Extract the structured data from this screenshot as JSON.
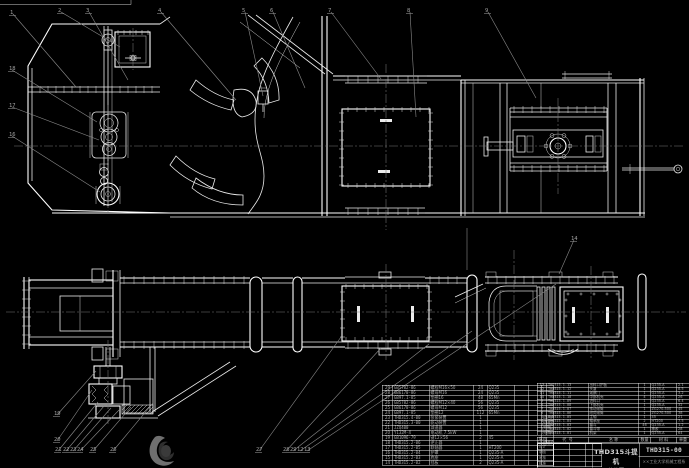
{
  "colors": {
    "background": "#000000",
    "line": "#ececec",
    "leader": "#8a8a8a",
    "table_text": "#a8a8a8",
    "stamp_dark": "#2e2e2e",
    "stamp_light": "#6f6f6f"
  },
  "title_block": {
    "product_title": "THD315斗提机",
    "sheet_name": "总装图",
    "drawing_number": "THD315-00",
    "company": "××工业大学机械工程系",
    "signature_labels": [
      "设计",
      "制图",
      "审核",
      "批准"
    ]
  },
  "bom": {
    "headers": [
      "序号",
      "代  号",
      "名  称",
      "数量",
      "材  料",
      "单重",
      "总重",
      "备注"
    ],
    "left_rows": [
      [
        "29",
        "GB5782-86",
        "螺栓M16×50",
        "24",
        "Q235",
        "",
        "",
        ""
      ],
      [
        "28",
        "GB6170-86",
        "螺母M16",
        "24",
        "Q235",
        "",
        "",
        ""
      ],
      [
        "27",
        "GB97.1-85",
        "垫圈16",
        "48",
        "65Mn",
        "",
        "",
        ""
      ],
      [
        "26",
        "GB5782-86",
        "螺栓M12×40",
        "56",
        "Q235",
        "",
        "",
        ""
      ],
      [
        "25",
        "GB6170-86",
        "螺母M12",
        "56",
        "Q235",
        "",
        "",
        ""
      ],
      [
        "24",
        "GB97.1-85",
        "垫圈12",
        "112",
        "65Mn",
        "",
        "",
        ""
      ],
      [
        "23",
        "THD315.4-00",
        "张紧装置",
        "1",
        "",
        "",
        "",
        "组合件"
      ],
      [
        "22",
        "THD315.3-00",
        "驱动装置",
        "1",
        "",
        "",
        "",
        "组合件"
      ],
      [
        "21",
        "JZQ400",
        "减速器",
        "1",
        "",
        "",
        "",
        "外购"
      ],
      [
        "20",
        "Y132M-4",
        "电动机 7.5kW",
        "1",
        "",
        "",
        "",
        "外购"
      ],
      [
        "19",
        "GB1096-79",
        "键12×56",
        "2",
        "45",
        "",
        "",
        ""
      ],
      [
        "18",
        "THD315.2-06",
        "逆止器",
        "1",
        "",
        "",
        "",
        "组合件"
      ],
      [
        "17",
        "THD315.2-05",
        "联轴器",
        "1",
        "HT200",
        "",
        "",
        ""
      ],
      [
        "16",
        "THD315.2-04",
        "护罩",
        "1",
        "Q235-A",
        "",
        "",
        ""
      ],
      [
        "15",
        "THD315.2-03",
        "底座",
        "1",
        "Q235-A",
        "",
        "",
        ""
      ],
      [
        "14",
        "THD315.2-02",
        "挡板",
        "2",
        "Q235-A",
        "",
        "",
        ""
      ]
    ],
    "right_rows": [
      [
        "13",
        "THD315.1-13",
        "出料口护板",
        "1",
        "Q235-A",
        "2.1",
        "2.1",
        ""
      ],
      [
        "12",
        "THD315.1-12",
        "头罩",
        "1",
        "Q235-A",
        "8.5",
        "8.5",
        ""
      ],
      [
        "11",
        "THD315.1-11",
        "观察门",
        "1",
        "Q235-A",
        "3.2",
        "3.2",
        ""
      ],
      [
        "10",
        "THD315.1-10",
        "中部机壳",
        "4",
        "Q235-A",
        "26",
        "104",
        ""
      ],
      [
        "9",
        "THD315.1-09",
        "进料口",
        "1",
        "Q235-A",
        "6.4",
        "6.4",
        ""
      ],
      [
        "8",
        "THD315.1-08",
        "下部机壳",
        "1",
        "Q235-A",
        "32",
        "32",
        ""
      ],
      [
        "7",
        "THD315.1-07",
        "传动滚筒",
        "1",
        "ZG270-500",
        "45",
        "45",
        ""
      ],
      [
        "6",
        "THD315.1-06",
        "改向滚筒",
        "1",
        "ZG270-500",
        "38",
        "38",
        ""
      ],
      [
        "5",
        "THD315.1-05",
        "主轴",
        "1",
        "45",
        "21",
        "21",
        ""
      ],
      [
        "4",
        "THD315.1-04",
        "轴承座",
        "2",
        "HT200",
        "7.5",
        "15",
        ""
      ],
      [
        "3",
        "THD315.1-03",
        "畚斗",
        "46",
        "Q235-A",
        "1.2",
        "55",
        ""
      ],
      [
        "2",
        "THD315.1-02",
        "畚斗带",
        "1",
        "橡胶",
        "28",
        "28",
        ""
      ],
      [
        "1",
        "THD315.1-01",
        "机架",
        "1",
        "Q235-A",
        "64",
        "64",
        ""
      ]
    ]
  },
  "callouts": [
    {
      "n": "1",
      "x": 10,
      "y": 9,
      "tx": 76,
      "ty": 87
    },
    {
      "n": "2",
      "x": 58,
      "y": 7,
      "tx": 120,
      "ty": 47
    },
    {
      "n": "3",
      "x": 86,
      "y": 7,
      "tx": 128,
      "ty": 80
    },
    {
      "n": "4",
      "x": 158,
      "y": 7,
      "tx": 236,
      "ty": 100
    },
    {
      "n": "5",
      "x": 242,
      "y": 7,
      "tx": 263,
      "ty": 96
    },
    {
      "n": "6",
      "x": 270,
      "y": 7,
      "tx": 305,
      "ty": 88
    },
    {
      "n": "7",
      "x": 328,
      "y": 7,
      "tx": 381,
      "ty": 79
    },
    {
      "n": "8",
      "x": 407,
      "y": 7,
      "tx": 416,
      "ty": 117
    },
    {
      "n": "9",
      "x": 485,
      "y": 7,
      "tx": 536,
      "ty": 98
    },
    {
      "n": "18",
      "x": 9,
      "y": 65,
      "tx": 97,
      "ty": 122
    },
    {
      "n": "17",
      "x": 9,
      "y": 102,
      "tx": 99,
      "ty": 140
    },
    {
      "n": "16",
      "x": 9,
      "y": 131,
      "tx": 100,
      "ty": 192
    },
    {
      "n": "19",
      "x": 54,
      "y": 410,
      "tx": 96,
      "ty": 371
    },
    {
      "n": "20",
      "x": 54,
      "y": 436,
      "tx": 92,
      "ty": 390
    },
    {
      "n": "21",
      "x": 55,
      "y": 446,
      "tx": 98,
      "ty": 402
    },
    {
      "n": "22",
      "x": 63,
      "y": 446,
      "tx": 104,
      "ty": 406
    },
    {
      "n": "23",
      "x": 70,
      "y": 446,
      "tx": 111,
      "ty": 408
    },
    {
      "n": "24",
      "x": 77,
      "y": 446,
      "tx": 119,
      "ty": 410
    },
    {
      "n": "25",
      "x": 90,
      "y": 446,
      "tx": 131,
      "ty": 407
    },
    {
      "n": "26",
      "x": 110,
      "y": 446,
      "tx": 153,
      "ty": 403
    },
    {
      "n": "27",
      "x": 256,
      "y": 446,
      "tx": 341,
      "ty": 337
    },
    {
      "n": "28",
      "x": 283,
      "y": 446,
      "tx": 381,
      "ty": 348
    },
    {
      "n": "29",
      "x": 290,
      "y": 446,
      "tx": 429,
      "ty": 344
    },
    {
      "n": "12",
      "x": 297,
      "y": 446,
      "tx": 472,
      "ty": 331
    },
    {
      "n": "13",
      "x": 304,
      "y": 446,
      "tx": 556,
      "ty": 284
    },
    {
      "n": "14",
      "x": 571,
      "y": 235,
      "tx": 559,
      "ty": 274
    }
  ]
}
